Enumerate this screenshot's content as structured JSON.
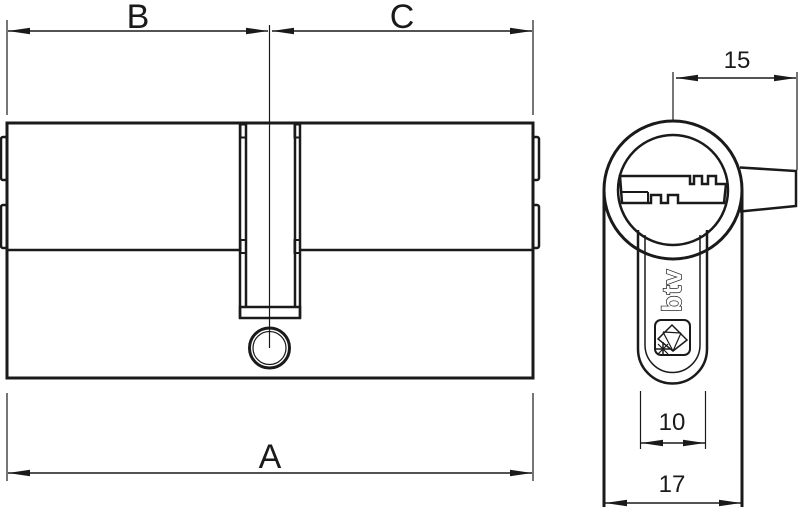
{
  "labels": {
    "left_length": "B",
    "right_length": "C",
    "overall_length": "A",
    "cam_reach": "15",
    "neck_width": "10",
    "body_width": "17"
  },
  "logo": {
    "text": "btv"
  },
  "colors": {
    "line": "#1a1a1a",
    "background": "#ffffff"
  }
}
